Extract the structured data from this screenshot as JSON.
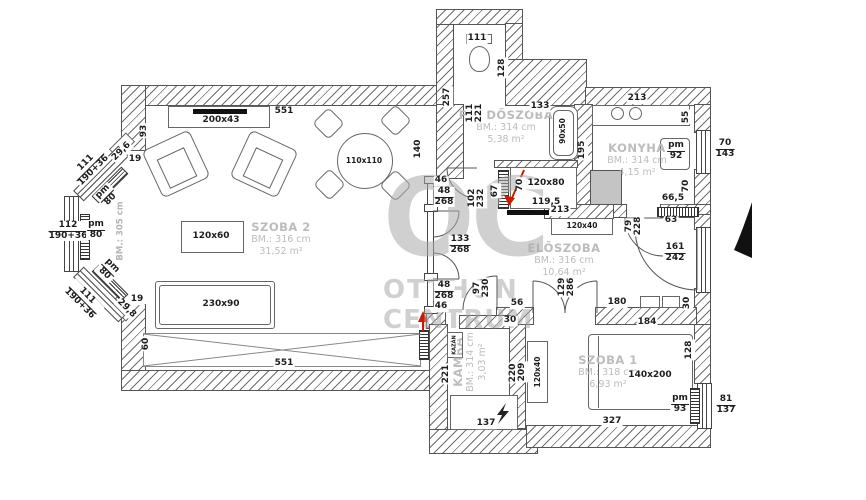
{
  "watermark": {
    "line1": "OC",
    "line2": "OTTHON",
    "line3": "CENTRUM"
  },
  "rooms": {
    "szoba2": {
      "name": "SZOBA 2",
      "bm": "BM.: 316 cm",
      "area": "31,52 m²"
    },
    "furdoszoba": {
      "name": "FÜRDŐSZOBA",
      "bm": "BM.: 314 cm",
      "area": "5,38 m²"
    },
    "konyha": {
      "name": "KONYHA",
      "bm": "BM.: 314 cm",
      "area": "4,15 m²"
    },
    "eloszoba": {
      "name": "ELŐSZOBA",
      "bm": "BM.: 316 cm",
      "area": "10,64 m²"
    },
    "szoba1": {
      "name": "SZOBA 1",
      "bm": "BM.: 318 cm",
      "area": "6,93 m²"
    },
    "kamra": {
      "name": "KAMRA",
      "bm": "BM.: 314 cm",
      "area": "3,03 m²"
    }
  },
  "colors": {
    "wall_line": "#555555",
    "hatch": "#6e6e6e",
    "label": "#1d1d1d",
    "room_label": "#bcbcbc",
    "watermark": "#aaaaaa",
    "entrance_arrow": "#cc1a00",
    "appliance_fill": "#c4c4c4",
    "north_arrow": "#111111"
  },
  "dim_labels": [
    {
      "t": "551",
      "x": 284,
      "y": 112
    },
    {
      "t": "93",
      "x": 145,
      "y": 131,
      "r": -90
    },
    {
      "t": "200x43",
      "x": 221,
      "y": 121
    },
    {
      "t": "140",
      "x": 419,
      "y": 149,
      "r": -90
    },
    {
      "t": "29,6",
      "x": 122,
      "y": 152,
      "r": -45
    },
    {
      "t": "19",
      "x": 135,
      "y": 160
    },
    {
      "t": "111",
      "d": "190+36",
      "x": 90,
      "y": 167,
      "r": -45
    },
    {
      "t": "pm",
      "d": "80",
      "x": 107,
      "y": 196,
      "r": -45
    },
    {
      "t": "112",
      "d": "190+36",
      "x": 68,
      "y": 231
    },
    {
      "t": "pm",
      "d": "80",
      "x": 96,
      "y": 230
    },
    {
      "t": "BM.: 305 cm",
      "x": 121,
      "y": 231,
      "r": -90,
      "cls": "note"
    },
    {
      "t": "pm",
      "d": "80",
      "x": 108,
      "y": 270,
      "r": 45
    },
    {
      "t": "111",
      "d": "190+36",
      "x": 83,
      "y": 300,
      "r": 45
    },
    {
      "t": "29,8",
      "x": 126,
      "y": 309,
      "r": 45
    },
    {
      "t": "19",
      "x": 137,
      "y": 300
    },
    {
      "t": "60",
      "x": 147,
      "y": 344,
      "r": -90
    },
    {
      "t": "551",
      "x": 284,
      "y": 364
    },
    {
      "t": "120x60",
      "x": 211,
      "y": 237
    },
    {
      "t": "230x90",
      "x": 221,
      "y": 305
    },
    {
      "t": "110x110",
      "x": 364,
      "y": 161,
      "cls": "small"
    },
    {
      "t": "46",
      "x": 441,
      "y": 181
    },
    {
      "t": "48",
      "d": "268",
      "x": 444,
      "y": 197
    },
    {
      "t": "133",
      "d": "268",
      "x": 460,
      "y": 245
    },
    {
      "t": "48",
      "d": "268",
      "x": 444,
      "y": 291
    },
    {
      "t": "46",
      "x": 441,
      "y": 307
    },
    {
      "t": "257",
      "x": 448,
      "y": 97,
      "r": -90
    },
    {
      "t": "111",
      "x": 471,
      "y": 113,
      "r": -90
    },
    {
      "t": "221",
      "x": 480,
      "y": 113,
      "r": -90
    },
    {
      "t": "111",
      "x": 477,
      "y": 39
    },
    {
      "t": "128",
      "x": 503,
      "y": 68,
      "r": -90
    },
    {
      "t": "133",
      "x": 540,
      "y": 107
    },
    {
      "t": "90x50",
      "x": 563,
      "y": 131,
      "r": -90,
      "cls": "small"
    },
    {
      "t": "195",
      "x": 583,
      "y": 150,
      "r": -90
    },
    {
      "t": "102",
      "x": 473,
      "y": 198,
      "r": -90
    },
    {
      "t": "232",
      "x": 482,
      "y": 198,
      "r": -90
    },
    {
      "t": "67",
      "x": 496,
      "y": 191,
      "r": -90
    },
    {
      "t": "70",
      "x": 521,
      "y": 185,
      "r": -90
    },
    {
      "t": "120x80",
      "x": 546,
      "y": 184
    },
    {
      "t": "119,5",
      "x": 546,
      "y": 203
    },
    {
      "t": "213",
      "x": 637,
      "y": 99
    },
    {
      "t": "55",
      "x": 687,
      "y": 117,
      "r": -90
    },
    {
      "t": "pm",
      "d": "92",
      "x": 676,
      "y": 151
    },
    {
      "t": "70",
      "d": "143",
      "x": 725,
      "y": 149
    },
    {
      "t": "70",
      "x": 687,
      "y": 186,
      "r": -90
    },
    {
      "t": "66,5",
      "x": 673,
      "y": 199
    },
    {
      "t": "63",
      "x": 671,
      "y": 221
    },
    {
      "t": "79",
      "x": 630,
      "y": 226,
      "r": -90
    },
    {
      "t": "228",
      "x": 639,
      "y": 226,
      "r": -90
    },
    {
      "t": "213",
      "x": 560,
      "y": 211
    },
    {
      "t": "120x40",
      "x": 582,
      "y": 226,
      "cls": "small"
    },
    {
      "t": "161",
      "d": "242",
      "x": 675,
      "y": 253
    },
    {
      "t": "180",
      "x": 617,
      "y": 303
    },
    {
      "t": "30",
      "x": 688,
      "y": 303,
      "r": -90
    },
    {
      "t": "184",
      "x": 647,
      "y": 323
    },
    {
      "t": "129",
      "x": 563,
      "y": 287,
      "r": -90
    },
    {
      "t": "286",
      "x": 572,
      "y": 287,
      "r": -90
    },
    {
      "t": "97",
      "x": 478,
      "y": 288,
      "r": -90
    },
    {
      "t": "230",
      "x": 487,
      "y": 288,
      "r": -90
    },
    {
      "t": "56",
      "x": 517,
      "y": 304
    },
    {
      "t": "30",
      "x": 510,
      "y": 321
    },
    {
      "t": "221",
      "x": 447,
      "y": 374,
      "r": -90
    },
    {
      "t": "220",
      "x": 514,
      "y": 373,
      "r": -90
    },
    {
      "t": "KAZÁN",
      "x": 455,
      "y": 345,
      "r": -90,
      "cls": "tiny"
    },
    {
      "t": "137",
      "x": 486,
      "y": 424
    },
    {
      "t": "209",
      "x": 523,
      "y": 372,
      "r": -90
    },
    {
      "t": "120x40",
      "x": 538,
      "y": 372,
      "r": -90,
      "cls": "small"
    },
    {
      "t": "128",
      "x": 690,
      "y": 350,
      "r": -90
    },
    {
      "t": "140x200",
      "x": 650,
      "y": 376
    },
    {
      "t": "327",
      "x": 612,
      "y": 422
    },
    {
      "t": "pm",
      "d": "93",
      "x": 680,
      "y": 404
    },
    {
      "t": "81",
      "d": "137",
      "x": 726,
      "y": 405
    }
  ]
}
